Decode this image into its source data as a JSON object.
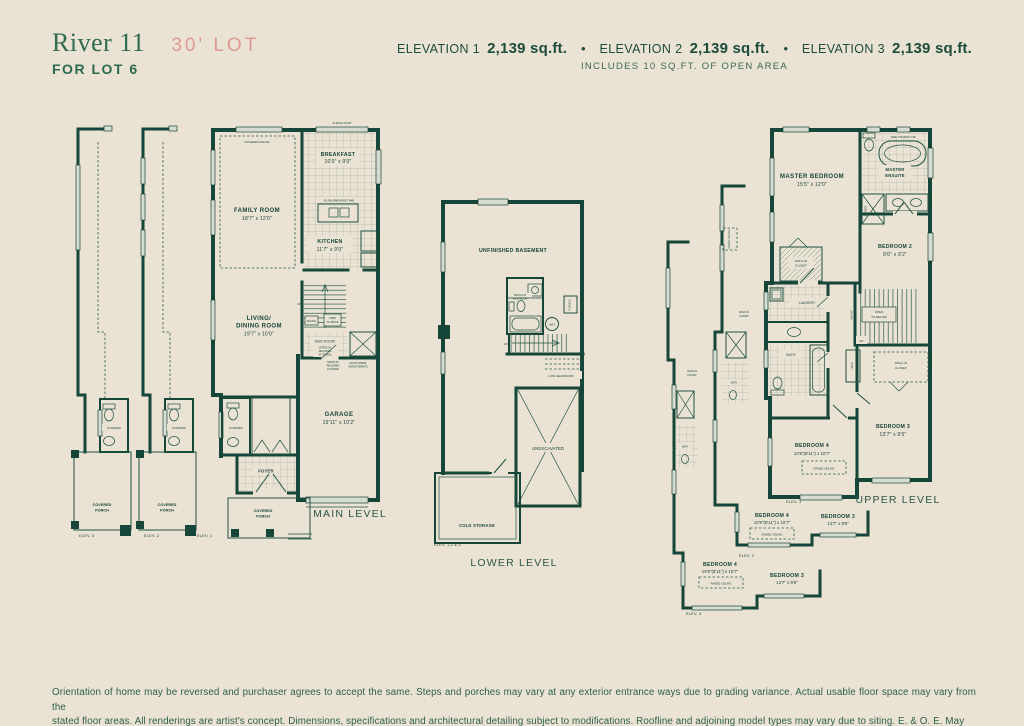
{
  "header": {
    "model_name": "River 11",
    "lot_tag": "30' LOT",
    "for_lot": "FOR LOT 6",
    "bullet": "•",
    "elevations": [
      {
        "label": "ELEVATION 1",
        "area": "2,139 sq.ft."
      },
      {
        "label": "ELEVATION 2",
        "area": "2,139 sq.ft."
      },
      {
        "label": "ELEVATION 3",
        "area": "2,139 sq.ft."
      }
    ],
    "open_area_note": "INCLUDES 10 SQ.FT. OF OPEN AREA"
  },
  "main_level": {
    "title": "MAIN LEVEL",
    "family_room": {
      "name": "FAMILY ROOM",
      "dims": "18'7\" x 12'0\"",
      "note": "COFFERED CEILING"
    },
    "breakfast": {
      "name": "BREAKFAST",
      "dims": "10'0\" x 9'0\""
    },
    "kitchen": {
      "name": "KITCHEN",
      "dims": "11'7\" x 9'0\"",
      "bar_note": "FLUSH BREAKFAST BAR"
    },
    "living_dining": {
      "name1": "LIVING/",
      "name2": "DINING ROOM",
      "dims": "19'7\" x 10'0\""
    },
    "garage": {
      "name": "GARAGE",
      "dims": "19'11\" x 10'2\""
    },
    "mud_room": {
      "name": "MUD ROOM",
      "note1": "(STEPS AS",
      "note2": "REQUIRED",
      "note3": "AT GRADE)"
    },
    "grade_note_a": [
      "STEPS AS",
      "REQUIRED",
      "AT GRADE"
    ],
    "grade_note_b": [
      "DOOR WHERE",
      "GRADE PERMITS"
    ],
    "sliding_door": "SLIDING DOOR",
    "railing": "RAILING",
    "open_to_above": [
      "OPEN",
      "TO ABOVE"
    ],
    "up": "UP",
    "powder": "POWDER",
    "foyer": "FOYER",
    "covered_porch": [
      "COVERED",
      "PORCH"
    ],
    "elev_labels": [
      "ELEV. 3",
      "ELEV. 2",
      "ELEV. 1"
    ]
  },
  "lower_level": {
    "title": "LOWER LEVEL",
    "unfinished_basement": "UNFINISHED BASEMENT",
    "washroom": [
      "ROUGH-IN",
      "WASHROOM"
    ],
    "hwt": "HWT",
    "furnace": "FURNACE",
    "up": "UP",
    "low_headroom": "LOW HEADROOM",
    "unexcavated": "UNEXCAVATED",
    "cold_storage": "COLD STORAGE",
    "elev_label": "ELEV. 1,2 & 3"
  },
  "upper_level": {
    "title": "UPPER LEVEL",
    "master_bedroom": {
      "name": "MASTER BEDROOM",
      "dims": "15'5\" x 12'0\""
    },
    "master_ensuite": [
      "MASTER",
      "ENSUITE"
    ],
    "free_standing_tub": "FREE STANDING TUB",
    "shower": "SHOWER",
    "walk_in_closet": [
      "WALK-IN",
      "CLOSET"
    ],
    "bedroom2": {
      "name": "BEDROOM 2",
      "dims": "9'6\" x 9'2\""
    },
    "bedroom3": {
      "name": "BEDROOM 3",
      "dims": "13'7\" x 9'5\""
    },
    "bedroom4": {
      "name": "BEDROOM 4",
      "dims": "10'9\"(8'11\") x 10'7\""
    },
    "laundry": "LAUNDRY",
    "bath": "BATH",
    "linen": "LINEN",
    "railing": "RAILING",
    "open_to_below": [
      "OPEN",
      "TO BELOW"
    ],
    "dn": "DN",
    "raised_ceiling": "RAISED CEILING",
    "elev_labels": [
      "ELEV. 1",
      "ELEV. 2",
      "ELEV. 3"
    ]
  },
  "footer": {
    "line1": "Orientation of home may be reversed and purchaser agrees to accept the same. Steps and porches may vary at any exterior entrance ways due to grading variance. Actual usable floor space may vary from the",
    "line2": "stated floor areas. All renderings are artist's concept. Dimensions, specifications and architectural detailing subject to modifications. Roofline and adjoining model types may vary due to siting. E. & O. E. May 2023"
  },
  "colors": {
    "background": "#EAE2D3",
    "wall_green": "#16453A",
    "accent_salmon": "#DE9A90",
    "heading_green": "#2F6B50"
  }
}
